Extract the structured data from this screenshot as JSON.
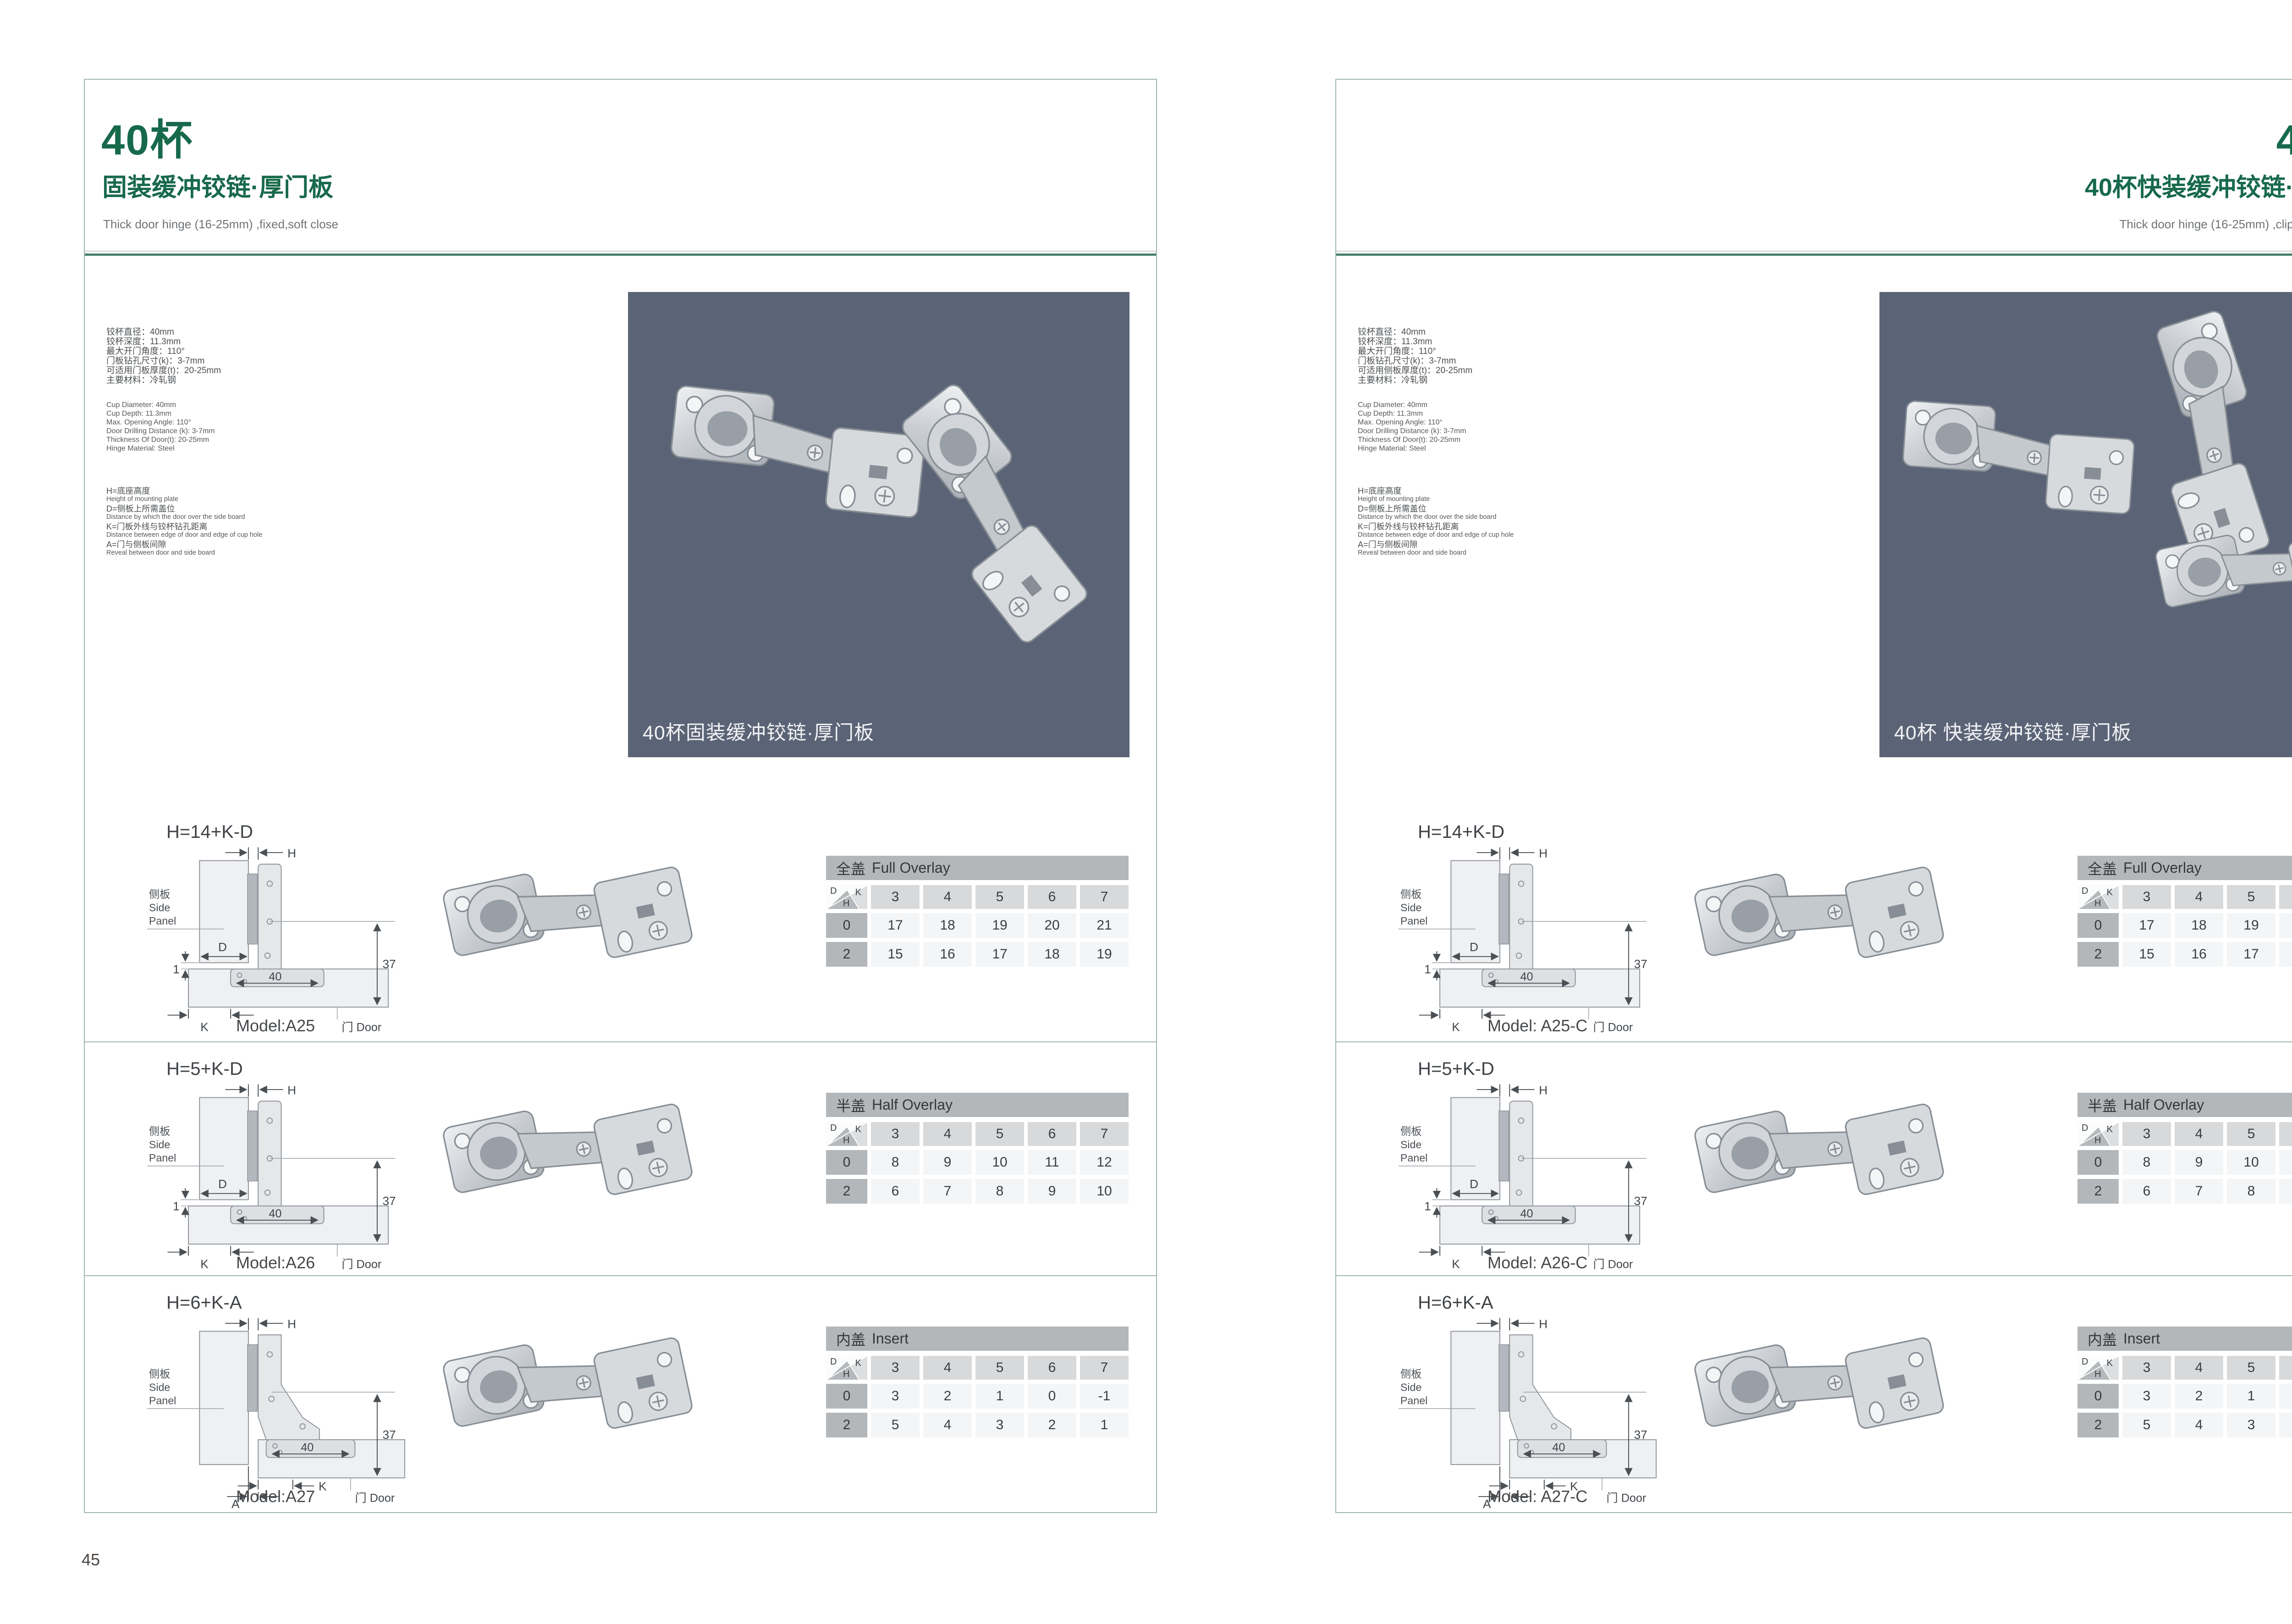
{
  "colors": {
    "accent_green": "#17694b",
    "rule_green": "#47806a",
    "page_border": "#9fb6a9",
    "photo_background": "#5b6476",
    "table_title_bar": "#b4b7ba",
    "table_header_cell": "#d7d9da",
    "table_value_cell": "#f4f5f6"
  },
  "diagram_labels": {
    "h": "H",
    "d": "D",
    "k": "K",
    "a": "A",
    "gap": "1",
    "width40": "40",
    "height37": "37",
    "side_cn": "侧板",
    "side_en1": "Side",
    "side_en2": "Panel",
    "door": "门 Door"
  },
  "table_corner": {
    "d": "D",
    "k": "K",
    "h": "H"
  },
  "pages": [
    {
      "page_number": "45",
      "header": {
        "title": "40杯",
        "subtitle": "固装缓冲铰链·厚门板",
        "subtitle_en": "Thick door hinge (16-25mm)  ,fixed,soft close"
      },
      "specs_cn": [
        "铰杯直径：40mm",
        "铰杯深度：11.3mm",
        "最大开门角度：110°",
        "门板钻孔尺寸(k)：3-7mm",
        "可适用门板厚度(t)：20-25mm",
        "主要材料：冷轧钢"
      ],
      "specs_en": [
        "Cup Diameter: 40mm",
        "Cup Depth: 11.3mm",
        "Max. Opening Angle: 110°",
        "Door Drilling Distance (k): 3-7mm",
        "Thickness Of Door(t): 20-25mm",
        "Hinge Material: Steel"
      ],
      "legend": [
        {
          "cn": "H=底座高度",
          "en": "Height of mounting plate"
        },
        {
          "cn": "D=侧板上所需盖位",
          "en": "Distance by which the door over the side board"
        },
        {
          "cn": "K=门板外线与铰杯钻孔距离",
          "en": "Distance between edge of door and edge of cup hole"
        },
        {
          "cn": "A=门与侧板间隙",
          "en": "Reveal between door and side board"
        }
      ],
      "photo_caption": "40杯固装缓冲铰链·厚门板",
      "rows": [
        {
          "formula": "H=14+K-D",
          "model": "Model:A25",
          "diagram": "overlay",
          "table": {
            "title_cn": "全盖",
            "title_en": "Full Overlay",
            "cols": [
              "3",
              "4",
              "5",
              "6",
              "7"
            ],
            "body": [
              {
                "label": "0",
                "values": [
                  "17",
                  "18",
                  "19",
                  "20",
                  "21"
                ]
              },
              {
                "label": "2",
                "values": [
                  "15",
                  "16",
                  "17",
                  "18",
                  "19"
                ]
              }
            ]
          }
        },
        {
          "formula": "H=5+K-D",
          "model": "Model:A26",
          "diagram": "overlay",
          "table": {
            "title_cn": "半盖",
            "title_en": "Half Overlay",
            "cols": [
              "3",
              "4",
              "5",
              "6",
              "7"
            ],
            "body": [
              {
                "label": "0",
                "values": [
                  "8",
                  "9",
                  "10",
                  "11",
                  "12"
                ]
              },
              {
                "label": "2",
                "values": [
                  "6",
                  "7",
                  "8",
                  "9",
                  "10"
                ]
              }
            ]
          }
        },
        {
          "formula": "H=6+K-A",
          "model": "Model:A27",
          "diagram": "insert",
          "table": {
            "title_cn": "内盖",
            "title_en": "Insert",
            "cols": [
              "3",
              "4",
              "5",
              "6",
              "7"
            ],
            "body": [
              {
                "label": "0",
                "values": [
                  "3",
                  "2",
                  "1",
                  "0",
                  "-1"
                ]
              },
              {
                "label": "2",
                "values": [
                  "5",
                  "4",
                  "3",
                  "2",
                  "1"
                ]
              }
            ]
          }
        }
      ]
    },
    {
      "page_number": "46",
      "header": {
        "title": "40杯",
        "subtitle": "40杯快装缓冲铰链·厚门板",
        "subtitle_en": "Thick door hinge (16-25mm)  ,clip on ,soft close"
      },
      "specs_cn": [
        "铰杯直径：40mm",
        "铰杯深度：11.3mm",
        "最大开门角度：110°",
        "门板钻孔尺寸(k)：3-7mm",
        "可适用侧板厚度(t)：20-25mm",
        "主要材料：冷轧钢"
      ],
      "specs_en": [
        "Cup Diameter: 40mm",
        "Cup Depth: 11.3mm",
        "Max. Opening Angle: 110°",
        "Door Drilling Distance (k): 3-7mm",
        "Thickness Of Door(t): 20-25mm",
        "Hinge Material: Steel"
      ],
      "legend": [
        {
          "cn": "H=底座高度",
          "en": "Height of mounting plate"
        },
        {
          "cn": "D=侧板上所需盖位",
          "en": "Distance by which the door over the side board"
        },
        {
          "cn": "K=门板外线与铰杯钻孔距离",
          "en": "Distance between edge of door and edge of cup hole"
        },
        {
          "cn": "A=门与侧板间隙",
          "en": "Reveal between door and side board"
        }
      ],
      "photo_caption": "40杯 快装缓冲铰链·厚门板",
      "rows": [
        {
          "formula": "H=14+K-D",
          "model": "Model: A25-C",
          "diagram": "overlay",
          "table": {
            "title_cn": "全盖",
            "title_en": "Full Overlay",
            "cols": [
              "3",
              "4",
              "5",
              "6",
              "7"
            ],
            "body": [
              {
                "label": "0",
                "values": [
                  "17",
                  "18",
                  "19",
                  "20",
                  "21"
                ]
              },
              {
                "label": "2",
                "values": [
                  "15",
                  "16",
                  "17",
                  "18",
                  "19"
                ]
              }
            ]
          }
        },
        {
          "formula": "H=5+K-D",
          "model": "Model: A26-C",
          "diagram": "overlay",
          "table": {
            "title_cn": "半盖",
            "title_en": "Half Overlay",
            "cols": [
              "3",
              "4",
              "5",
              "6",
              "7"
            ],
            "body": [
              {
                "label": "0",
                "values": [
                  "8",
                  "9",
                  "10",
                  "11",
                  "12"
                ]
              },
              {
                "label": "2",
                "values": [
                  "6",
                  "7",
                  "8",
                  "9",
                  "10"
                ]
              }
            ]
          }
        },
        {
          "formula": "H=6+K-A",
          "model": "Model: A27-C",
          "diagram": "insert",
          "table": {
            "title_cn": "内盖",
            "title_en": "Insert",
            "cols": [
              "3",
              "4",
              "5",
              "6",
              "7"
            ],
            "body": [
              {
                "label": "0",
                "values": [
                  "3",
                  "2",
                  "1",
                  "0",
                  "-1"
                ]
              },
              {
                "label": "2",
                "values": [
                  "5",
                  "4",
                  "3",
                  "2",
                  "1"
                ]
              }
            ]
          }
        }
      ]
    }
  ]
}
